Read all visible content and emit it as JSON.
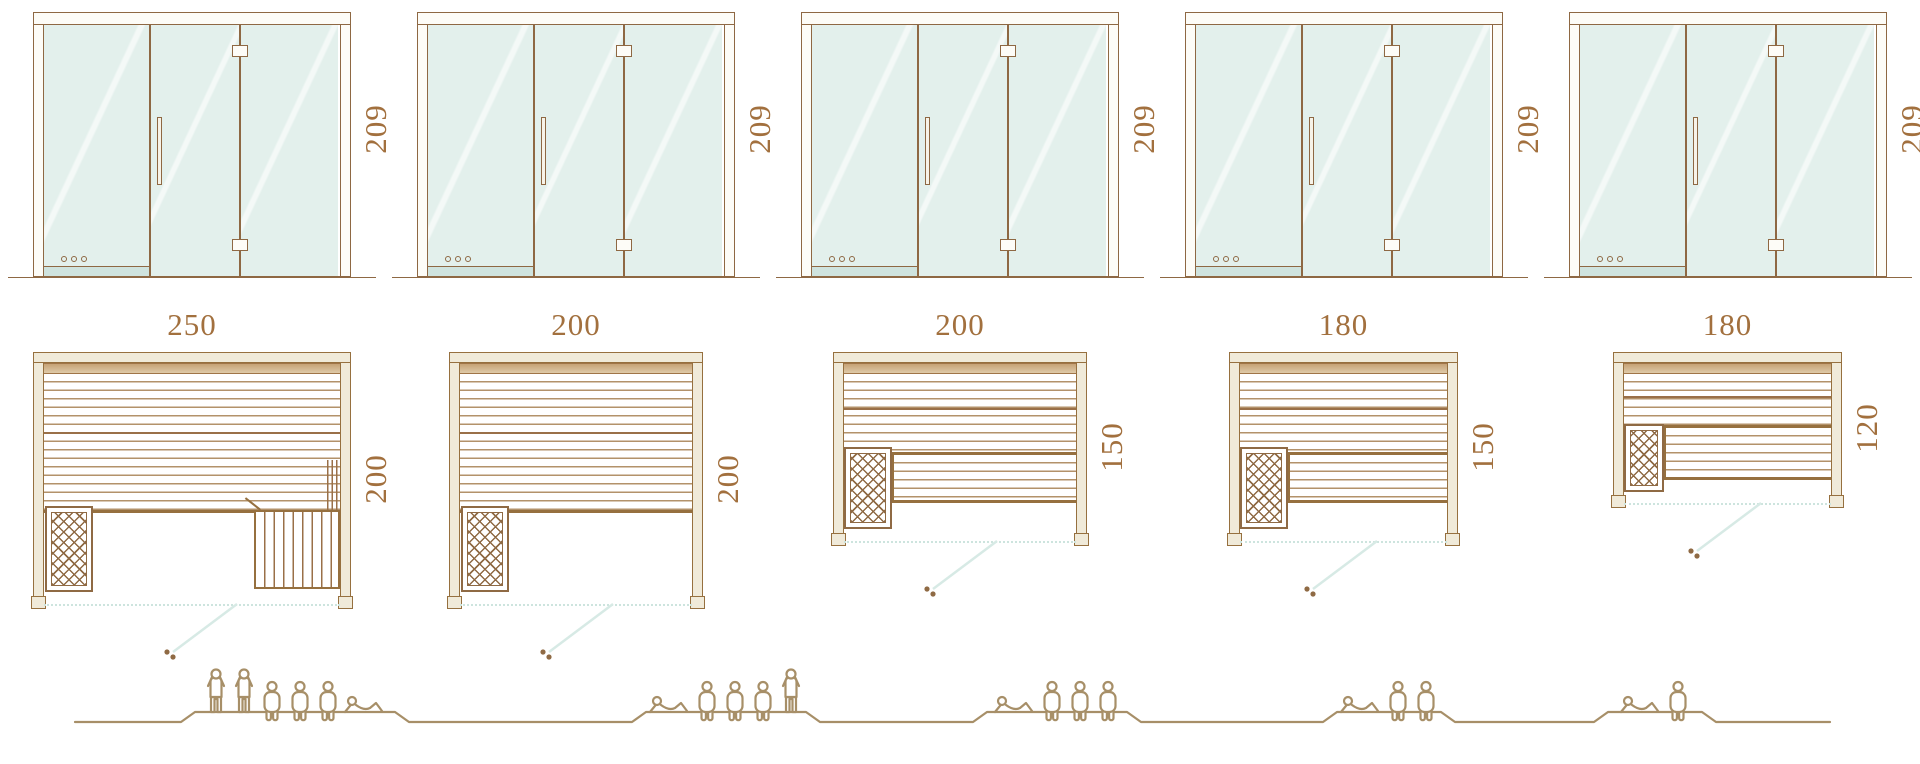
{
  "diagram": {
    "kind": "sauna size comparison diagram",
    "door_front_view": {
      "glass_panels": 3,
      "elements": [
        "left-glass-panel",
        "door-panel-with-handle",
        "hinged-glass-panel",
        "vent-holes"
      ]
    },
    "models": [
      {
        "door_height_label": "209",
        "plan_width_label": "250",
        "plan_depth_label": "200",
        "capacity": 6,
        "occupants": [
          "standing",
          "standing",
          "seated",
          "seated",
          "seated",
          "lying"
        ],
        "plan_features": [
          "heater",
          "full-width-bench",
          "side-step-bench",
          "open-glass-front",
          "door-swing"
        ]
      },
      {
        "door_height_label": "209",
        "plan_width_label": "200",
        "plan_depth_label": "200",
        "capacity": 5,
        "occupants": [
          "lying",
          "seated",
          "seated",
          "seated",
          "standing"
        ],
        "plan_features": [
          "heater",
          "full-width-bench",
          "open-glass-front",
          "door-swing"
        ]
      },
      {
        "door_height_label": "209",
        "plan_width_label": "200",
        "plan_depth_label": "150",
        "capacity": 4,
        "occupants": [
          "lying",
          "seated",
          "seated",
          "seated"
        ],
        "plan_features": [
          "heater",
          "upper-bench",
          "lower-bench",
          "open-glass-front",
          "door-swing"
        ]
      },
      {
        "door_height_label": "209",
        "plan_width_label": "180",
        "plan_depth_label": "150",
        "capacity": 3,
        "occupants": [
          "lying",
          "seated",
          "seated"
        ],
        "plan_features": [
          "heater",
          "upper-bench",
          "lower-bench",
          "open-glass-front",
          "door-swing"
        ]
      },
      {
        "door_height_label": "209",
        "plan_width_label": "180",
        "plan_depth_label": "120",
        "capacity": 2,
        "occupants": [
          "lying",
          "seated"
        ],
        "plan_features": [
          "heater",
          "upper-bench",
          "lower-bench",
          "open-glass-front",
          "door-swing"
        ]
      }
    ],
    "colors": {
      "outline_brown": "#8e6843",
      "wood_beige": "#f0ead9",
      "glass_teal": "#e3f0ec",
      "bench_band_tan": "#cfae83",
      "dimension_text": "#a2703e",
      "people_tan": "#a78f68",
      "door_swing_teal": "#d7eae5"
    }
  }
}
